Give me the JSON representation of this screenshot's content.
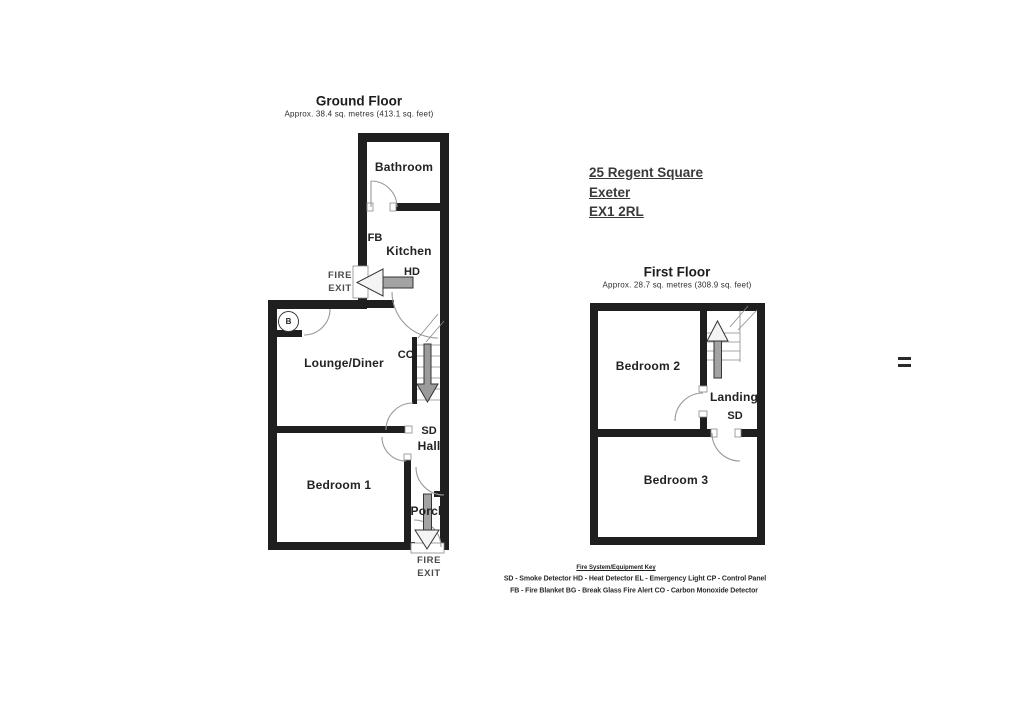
{
  "document": {
    "type": "floorplan",
    "address": {
      "line1": "25 Regent Square",
      "line2": "Exeter",
      "line3": "EX1 2RL"
    }
  },
  "ground_floor": {
    "title": "Ground Floor",
    "subtitle": "Approx. 38.4 sq. metres (413.1 sq. feet)",
    "rooms": {
      "bathroom": "Bathroom",
      "kitchen": "Kitchen",
      "lounge": "Lounge/Diner",
      "hall": "Hall",
      "bedroom1": "Bedroom 1",
      "porch": "Porch"
    },
    "equipment": {
      "fb": "FB",
      "hd": "HD",
      "co": "CO",
      "sd": "SD",
      "boiler": "B"
    },
    "fire_exit_side": {
      "line1": "FIRE",
      "line2": "EXIT"
    },
    "fire_exit_bottom": {
      "line1": "FIRE",
      "line2": "EXIT"
    }
  },
  "first_floor": {
    "title": "First Floor",
    "subtitle": "Approx. 28.7 sq. metres (308.9 sq. feet)",
    "rooms": {
      "bedroom2": "Bedroom 2",
      "landing": "Landing",
      "bedroom3": "Bedroom 3"
    },
    "equipment": {
      "sd": "SD"
    }
  },
  "fire_key": {
    "title": "Fire System/Equipment Key",
    "line1": "SD - Smoke Detector  HD - Heat Detector  EL - Emergency Light  CP - Control Panel",
    "line2": "FB - Fire Blanket  BG - Break Glass Fire Alert  CO - Carbon Monoxide Detector"
  },
  "colors": {
    "wall": "#1f1f1f",
    "arrow_shaft": "#a3a3a3",
    "arrow_head": "#f4f4f4",
    "door_arc": "#999999",
    "text": "#222222"
  }
}
